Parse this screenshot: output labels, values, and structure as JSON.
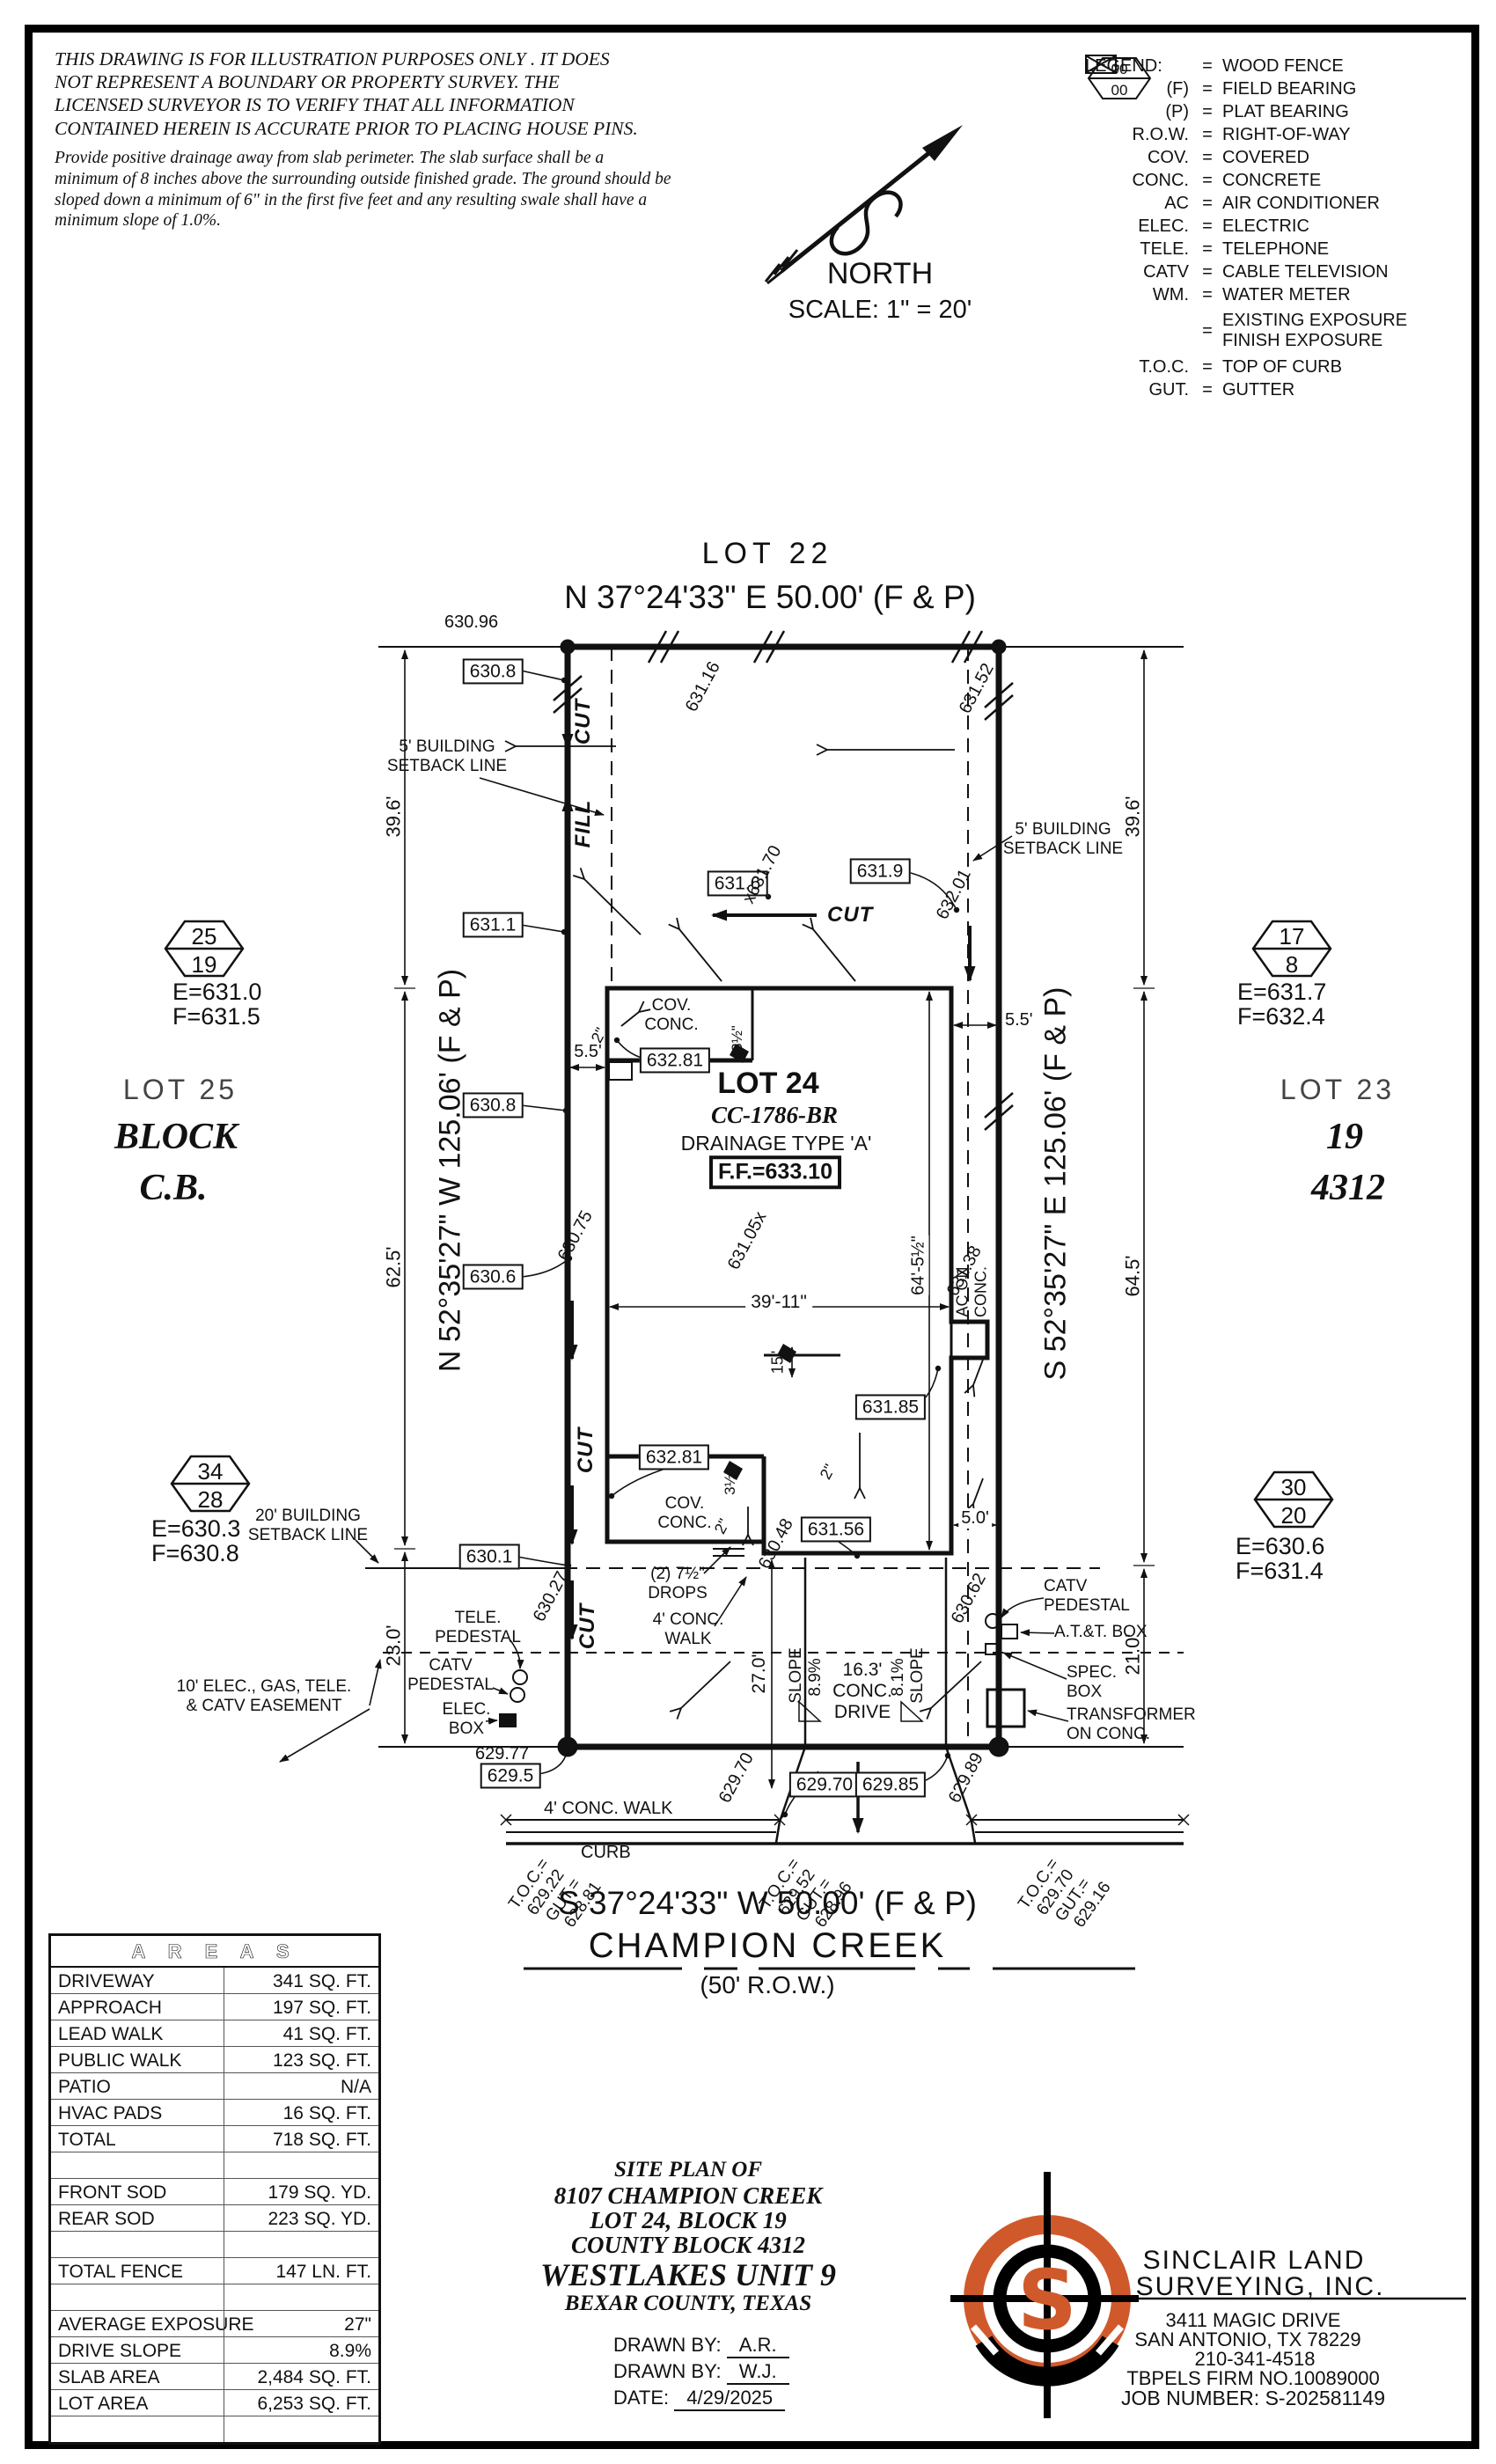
{
  "colors": {
    "accent": "#d0592c",
    "ink": "#111111"
  },
  "disclaimer": {
    "para1": "THIS DRAWING IS FOR ILLUSTRATION PURPOSES ONLY . IT DOES\nNOT REPRESENT A BOUNDARY OR PROPERTY SURVEY. THE\nLICENSED SURVEYOR IS TO VERIFY THAT ALL INFORMATION\nCONTAINED HEREIN IS ACCURATE PRIOR TO PLACING HOUSE PINS.",
    "para2": "Provide positive drainage away from slab perimeter. The slab surface shall be a\nminimum of 8 inches above the surrounding outside finished grade. The ground should be\nsloped down a minimum of 6\" in the first five feet and any resulting swale shall have a\nminimum slope of 1.0%."
  },
  "north": {
    "label": "NORTH",
    "scale": "SCALE:  1\" = 20'"
  },
  "legend": {
    "title": "LEGEND:",
    "rows": [
      {
        "sym": "\\\\",
        "desc": "WOOD FENCE"
      },
      {
        "sym": "(F)",
        "desc": "FIELD BEARING"
      },
      {
        "sym": "(P)",
        "desc": "PLAT BEARING"
      },
      {
        "sym": "R.O.W.",
        "desc": "RIGHT-OF-WAY"
      },
      {
        "sym": "COV.",
        "desc": "COVERED"
      },
      {
        "sym": "CONC.",
        "desc": "CONCRETE"
      },
      {
        "sym": "AC",
        "desc": "AIR CONDITIONER"
      },
      {
        "sym": "ELEC.",
        "desc": "ELECTRIC"
      },
      {
        "sym": "TELE.",
        "desc": "TELEPHONE"
      },
      {
        "sym": "CATV",
        "desc": "CABLE TELEVISION"
      },
      {
        "sym": "WM.",
        "desc": "WATER METER"
      }
    ],
    "exposure": {
      "top": "00",
      "bottom": "00",
      "desc": "EXISTING EXPOSURE\nFINISH EXPOSURE"
    },
    "toc": {
      "sym": "T.O.C.",
      "desc": "TOP OF CURB"
    },
    "gut": {
      "sym": "GUT.",
      "desc": "GUTTER"
    }
  },
  "plan": {
    "labels": {
      "lot22": "LOT 22",
      "bearing_top": "N 37°24'33\" E 50.00' (F & P)",
      "bearing_left": "N 52°35'27\" W 125.06' (F & P)",
      "bearing_right": "S 52°35'27\" E 125.06' (F & P)",
      "bearing_bottom": "S 37°24'33\" W 50.00' (F & P)",
      "street_name": "CHAMPION CREEK",
      "street_row": "(50' R.O.W.)",
      "lot25": "LOT 25",
      "block_word": "BLOCK",
      "block_cb": "C.B.",
      "lot23": "LOT 23",
      "block19": "19",
      "block4312": "4312",
      "lot24": "LOT 24",
      "plan_code": "CC-1786-BR",
      "drainage": "DRAINAGE TYPE 'A'",
      "ff": "F.F.=633.10",
      "cov_conc": "COV.\nCONC.",
      "ac_on_conc": "AC ON\nCONC.",
      "cut": "CUT",
      "fill": "FILL",
      "setback5": "5' BUILDING\nSETBACK LINE",
      "setback20": "20' BUILDING\nSETBACK LINE",
      "easement": "10' ELEC., GAS, TELE.\n& CATV EASEMENT",
      "drops": "(2) 7½\"\nDROPS",
      "walk4_house": "4' CONC.\nWALK",
      "walk4_street": "4' CONC. WALK",
      "curb": "CURB",
      "slope_word": "SLOPE",
      "slope89": "8.9%",
      "slope81": "8.1%",
      "drive163": "16.3'\nCONC.\nDRIVE",
      "tele_ped": "TELE.\nPEDESTAL",
      "catv_ped": "CATV\nPEDESTAL",
      "elec_box": "ELEC.\nBOX",
      "att_box": "A.T.&T. BOX",
      "spec_box": "SPEC.\nBOX",
      "transformer": "TRANSFORMER\nON CONC.",
      "e630_96": "630.96",
      "e629_77": "629.77",
      "b630_8a": "630.8",
      "b631_1": "631.1",
      "b630_8b": "630.8",
      "b630_6": "630.6",
      "b630_1": "630.1",
      "b629_5": "629.5",
      "b631_6": "631.6",
      "b631_9": "631.9",
      "b632_81a": "632.81",
      "b632_81b": "632.81",
      "b631_56": "631.56",
      "b631_85": "631.85",
      "b629_70": "629.70",
      "b629_85": "629.85",
      "s631_16": "631.16",
      "s631_52": "631.52",
      "s631_70": "x631.70",
      "s632_01": "632.01",
      "s631_05": "631.05x",
      "s630_75": "630.75",
      "s631_38": "631.38",
      "s630_27": "630.27",
      "s630_48": "630.48",
      "s630_62": "630.62",
      "s629_70": "629.70",
      "s629_89": "629.89",
      "d39_6": "39.6'",
      "d62_5": "62.5'",
      "d23_0": "23.0'",
      "d64_5": "64.5'",
      "d21_0": "21.0'",
      "d39_11": "39'-11\"",
      "d64_5h": "64'-5½\"",
      "d5_5": "5.5'",
      "d5_0": "5.0'",
      "d15": "15\"",
      "d27_0": "27.0'",
      "d2": "2\"",
      "d3h": "3½\"",
      "toc_eq": "T.O.C.=",
      "gut_eq": "GUT.=",
      "toc1": "629.22",
      "gut1": "628.81",
      "toc2": "629.52",
      "gut2": "628.96",
      "toc3": "629.70",
      "gut3": "629.16",
      "hex1_top": "25",
      "hex1_bot": "19",
      "hex1_e": "E=631.0",
      "hex1_f": "F=631.5",
      "hex2_top": "34",
      "hex2_bot": "28",
      "hex2_e": "E=630.3",
      "hex2_f": "F=630.8",
      "hex3_top": "17",
      "hex3_bot": "8",
      "hex3_e": "E=631.7",
      "hex3_f": "F=632.4",
      "hex4_top": "30",
      "hex4_bot": "20",
      "hex4_e": "E=630.6",
      "hex4_f": "F=631.4"
    }
  },
  "areas": {
    "title": "A R E A S",
    "rows": [
      {
        "label": "DRIVEWAY",
        "value": "341 SQ. FT."
      },
      {
        "label": "APPROACH",
        "value": "197 SQ. FT."
      },
      {
        "label": "LEAD WALK",
        "value": "41 SQ. FT."
      },
      {
        "label": "PUBLIC WALK",
        "value": "123 SQ. FT."
      },
      {
        "label": "PATIO",
        "value": "N/A"
      },
      {
        "label": "HVAC PADS",
        "value": "16 SQ. FT."
      },
      {
        "label": "TOTAL",
        "value": "718 SQ. FT."
      },
      {
        "label": "",
        "value": ""
      },
      {
        "label": "FRONT SOD",
        "value": "179 SQ. YD."
      },
      {
        "label": "REAR SOD",
        "value": "223 SQ. YD."
      },
      {
        "label": "",
        "value": ""
      },
      {
        "label": "TOTAL FENCE",
        "value": "147 LN. FT."
      },
      {
        "label": "",
        "value": ""
      },
      {
        "label": "AVERAGE EXPOSURE",
        "value": "27\""
      },
      {
        "label": "DRIVE SLOPE",
        "value": "8.9%"
      },
      {
        "label": "SLAB AREA",
        "value": "2,484 SQ. FT."
      },
      {
        "label": "LOT AREA",
        "value": "6,253 SQ. FT."
      },
      {
        "label": "",
        "value": ""
      }
    ]
  },
  "title_block": {
    "line1": "SITE PLAN OF",
    "line2": "8107 CHAMPION CREEK",
    "line3": "LOT 24, BLOCK 19",
    "line4": "COUNTY BLOCK 4312",
    "line5": "WESTLAKES UNIT 9",
    "line6": "BEXAR COUNTY, TEXAS",
    "drawn_by_label": "DRAWN BY:",
    "drawn_by_1": "A.R.",
    "drawn_by_2": "W.J.",
    "date_label": "DATE:",
    "date_value": "4/29/2025"
  },
  "company": {
    "name1": "SINCLAIR LAND",
    "name2": "SURVEYING, INC.",
    "addr1": "3411 MAGIC DRIVE",
    "addr2": "SAN ANTONIO, TX 78229",
    "phone": "210-341-4518",
    "firm": "TBPELS FIRM NO.10089000",
    "job": "JOB NUMBER: S-202581149",
    "logo_letter": "S"
  }
}
